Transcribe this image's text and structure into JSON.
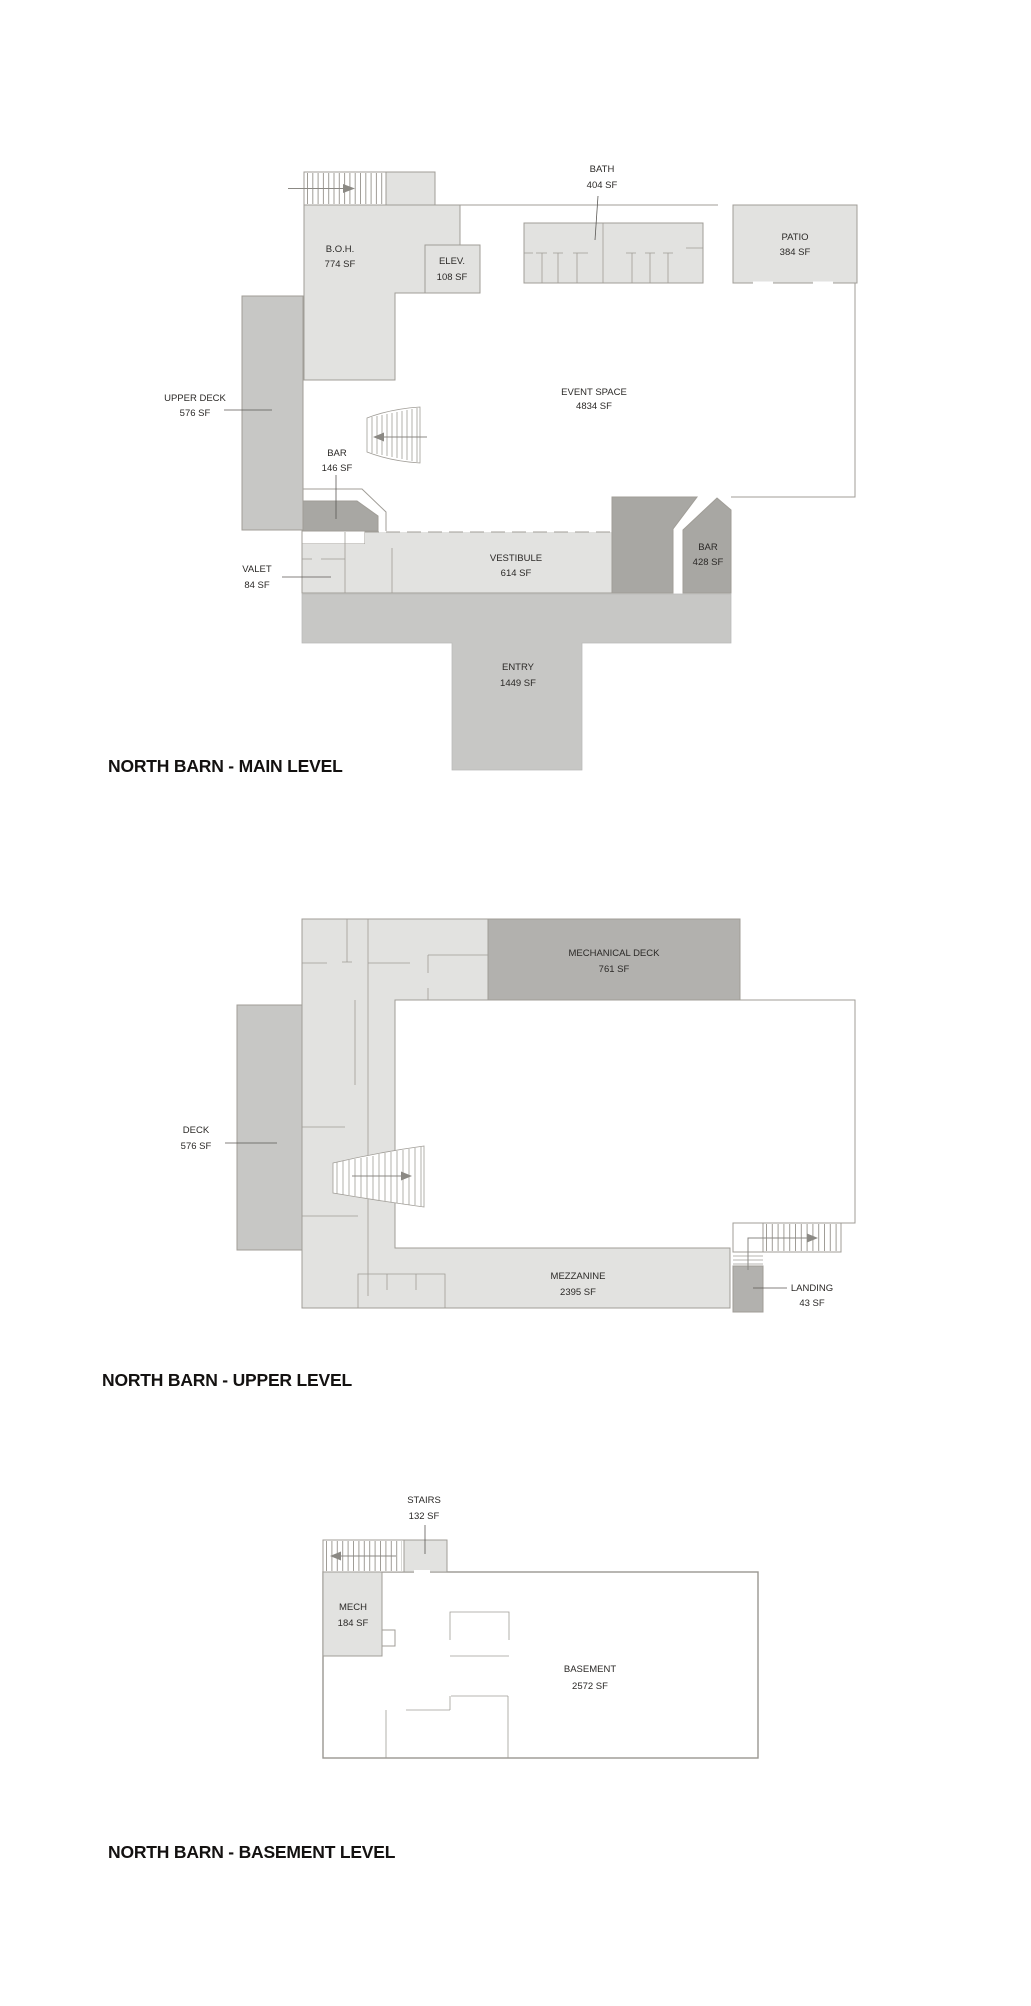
{
  "document": {
    "background": "#ffffff",
    "type": "architectural floor plan sheet"
  },
  "colors": {
    "room_fill_light": "#e2e2e0",
    "room_fill_medium": "#c7c7c5",
    "room_fill_dark": "#a8a7a3",
    "room_fill_dark_alt": "#b2b1ae",
    "wall_line": "#a09d97",
    "label_text": "#2b2927",
    "title_text": "#131110"
  },
  "levels": {
    "main": {
      "title": "NORTH BARN - MAIN LEVEL",
      "rooms": {
        "boh": {
          "name": "B.O.H.",
          "area": "774 SF"
        },
        "elev": {
          "name": "ELEV.",
          "area": "108 SF"
        },
        "bath": {
          "name": "BATH",
          "area": "404 SF"
        },
        "patio": {
          "name": "PATIO",
          "area": "384 SF"
        },
        "upper_deck": {
          "name": "UPPER DECK",
          "area": "576 SF"
        },
        "event_space": {
          "name": "EVENT SPACE",
          "area": "4834 SF"
        },
        "bar_small": {
          "name": "BAR",
          "area": "146 SF"
        },
        "bar_large": {
          "name": "BAR",
          "area": "428 SF"
        },
        "valet": {
          "name": "VALET",
          "area": "84 SF"
        },
        "vestibule": {
          "name": "VESTIBULE",
          "area": "614 SF"
        },
        "entry": {
          "name": "ENTRY",
          "area": "1449 SF"
        }
      }
    },
    "upper": {
      "title": "NORTH BARN - UPPER LEVEL",
      "rooms": {
        "mechanical_deck": {
          "name": "MECHANICAL DECK",
          "area": "761 SF"
        },
        "deck": {
          "name": "DECK",
          "area": "576 SF"
        },
        "mezzanine": {
          "name": "MEZZANINE",
          "area": "2395 SF"
        },
        "landing": {
          "name": "LANDING",
          "area": "43 SF"
        }
      }
    },
    "basement": {
      "title": "NORTH BARN - BASEMENT LEVEL",
      "rooms": {
        "stairs": {
          "name": "STAIRS",
          "area": "132 SF"
        },
        "mech": {
          "name": "MECH",
          "area": "184 SF"
        },
        "basement": {
          "name": "BASEMENT",
          "area": "2572 SF"
        }
      }
    }
  }
}
